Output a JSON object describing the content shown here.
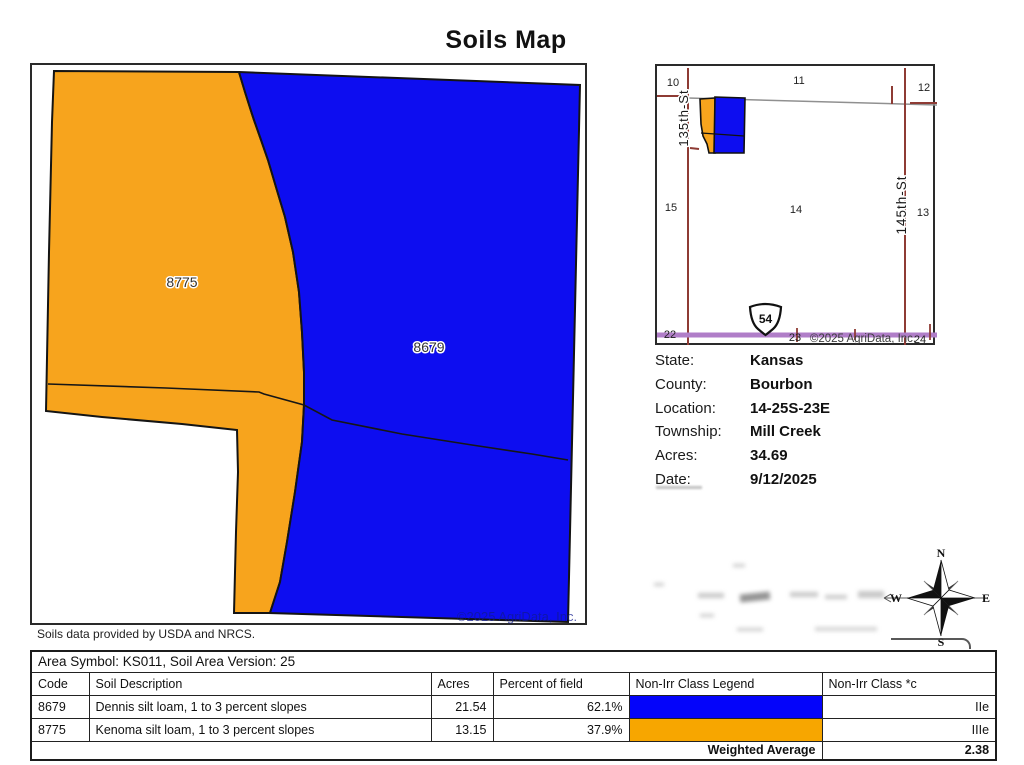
{
  "title": "Soils Map",
  "attribution": "Soils data provided by USDA and NRCS.",
  "main_map": {
    "orange_label": "8775",
    "blue_label": "8679",
    "watermark": "©2025 AgriData, Inc.",
    "colors": {
      "orange": "#F7A41D",
      "blue": "#0D0DF0",
      "outline": "#141414"
    }
  },
  "inset_map": {
    "section_numbers": [
      "10",
      "11",
      "12",
      "15",
      "14",
      "13",
      "22",
      "23",
      "24"
    ],
    "road_left": "135th-St",
    "road_right": "145th-St",
    "highway_shield": "54",
    "watermark": "©2025 AgriData, Inc.",
    "colors": {
      "road": "#8E3B34",
      "highway": "#B07EC8",
      "gray_line": "#909090"
    }
  },
  "info": {
    "rows": [
      {
        "label": "State:",
        "value": "Kansas"
      },
      {
        "label": "County:",
        "value": "Bourbon"
      },
      {
        "label": "Location:",
        "value": "14-25S-23E"
      },
      {
        "label": "Township:",
        "value": "Mill Creek"
      },
      {
        "label": "Acres:",
        "value": "34.69"
      },
      {
        "label": "Date:",
        "value": "9/12/2025"
      }
    ]
  },
  "compass": {
    "n": "N",
    "s": "S",
    "e": "E",
    "w": "W"
  },
  "table": {
    "area_header": "Area Symbol: KS011, Soil Area Version: 25",
    "columns": [
      "Code",
      "Soil Description",
      "Acres",
      "Percent of field",
      "Non-Irr Class Legend",
      "Non-Irr Class *c"
    ],
    "rows": [
      {
        "code": "8679",
        "description": "Dennis silt loam, 1 to 3 percent slopes",
        "acres": "21.54",
        "percent": "62.1%",
        "legend_color": "#0404FA",
        "class": "IIe"
      },
      {
        "code": "8775",
        "description": "Kenoma silt loam, 1 to 3 percent slopes",
        "acres": "13.15",
        "percent": "37.9%",
        "legend_color": "#F7A600",
        "class": "IIIe"
      }
    ],
    "footer": {
      "label": "Weighted Average",
      "value": "2.38"
    }
  }
}
